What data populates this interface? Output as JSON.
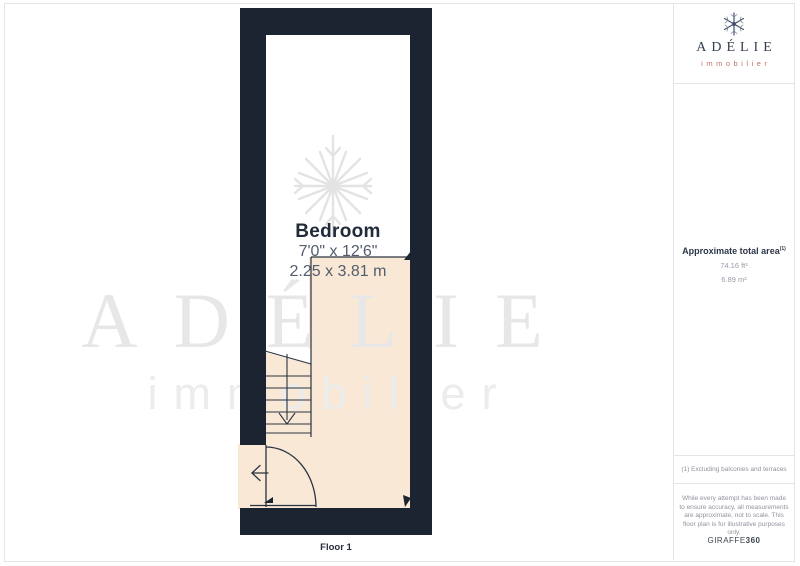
{
  "plan": {
    "room_name": "Bedroom",
    "dims_imperial": "7'0\" x 12'6\"",
    "dims_metric": "2.25 x 3.81 m",
    "floor_label": "Floor 1"
  },
  "watermark": {
    "brand": "ADÉLIE",
    "tagline": "immobilier"
  },
  "sidebar": {
    "logo_brand": "ADÉLIE",
    "logo_tagline": "immobilier",
    "area_title": "Approximate total area",
    "area_footnote_ref": "(1)",
    "area_imperial": "74.16 ft²",
    "area_metric": "6.89 m²",
    "footnote": "(1) Excluding balconies and terraces",
    "disclaimer": "While every attempt has been made to ensure accuracy, all measurements are approximate, not to scale. This floor plan is for illustrative purposes only.",
    "provider_name": "GIRAFFE",
    "provider_suffix": "360"
  },
  "icons": {
    "logo": "snowflake-icon",
    "plan_watermark": "snowflake-icon",
    "stairs": "arrow-down-icon",
    "entrance": "arrow-left-icon"
  },
  "colors": {
    "wall": "#1b2430",
    "floor": "#f9e8d6",
    "accent": "#c4736d",
    "navy": "#2c3647",
    "watermark_gray": "#e7e7e7"
  }
}
